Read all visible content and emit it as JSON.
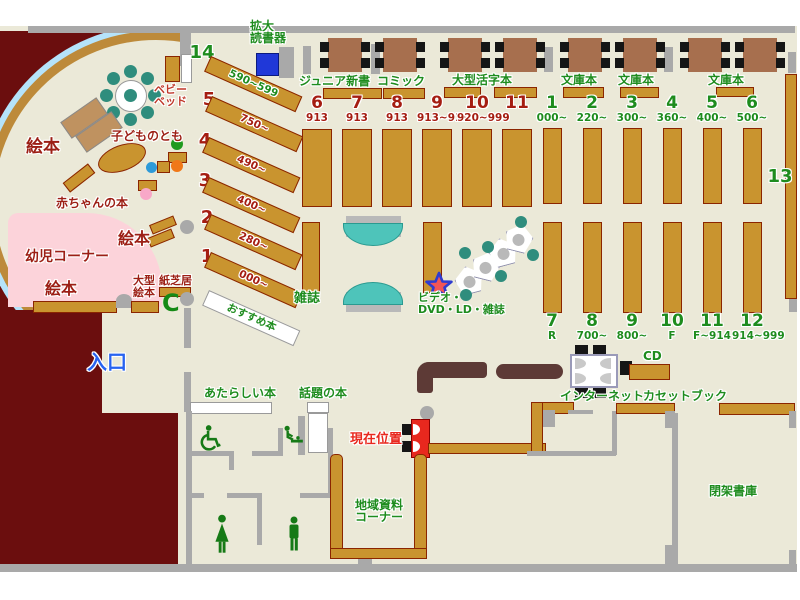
{
  "colors": {
    "floor": "#ebe9d8",
    "maroon": "#6b0e0e",
    "wall_gray": "#a9a9a9",
    "shelf_brown": "#c9942f",
    "shelf_border": "#8b2500",
    "table_brown": "#a76f4e",
    "counter_brown": "#5d3a36",
    "teal": "#2f8d7d",
    "pink": "#fcd3da",
    "arc_blue": "#b5e3fa",
    "green_text": "#1e8c1e",
    "dark_red_text": "#9c1f15",
    "marker_red": "#e8281e",
    "entrance_blue": "#2863f0",
    "reader_blue": "#2038d8"
  },
  "entrance": {
    "label": "入口"
  },
  "current_location": {
    "label": "現在位置"
  },
  "kids_area": {
    "picture_books_1": "絵本",
    "picture_books_2": "絵本",
    "picture_books_3": "絵本",
    "infant_corner": "幼児コーナー",
    "baby_books": "赤ちゃんの本",
    "kodomo_no_tomo": "子どものとも",
    "baby_bed_line1": "ベビー",
    "baby_bed_line2": "ベッド",
    "large_picture_line1": "大型",
    "large_picture_line2": "絵本",
    "kamishibai": "紙芝居",
    "bench_glyph": "C"
  },
  "top_area": {
    "magnifier_line1": "拡大",
    "magnifier_line2": "読書器",
    "junior_shinsho": "ジュニア新書",
    "comic": "コミック",
    "large_print": "大型活字本",
    "bunko_1": "文庫本",
    "bunko_2": "文庫本",
    "bunko_3": "文庫本"
  },
  "rows": {
    "red_top": [
      {
        "n": "6",
        "r": "913"
      },
      {
        "n": "7",
        "r": "913"
      },
      {
        "n": "8",
        "r": "913"
      },
      {
        "n": "9",
        "r": "913~919"
      },
      {
        "n": "10",
        "r": "920~999"
      },
      {
        "n": "11",
        "r": ""
      }
    ],
    "green_top": [
      {
        "n": "1",
        "r": "000~"
      },
      {
        "n": "2",
        "r": "220~"
      },
      {
        "n": "3",
        "r": "300~"
      },
      {
        "n": "4",
        "r": "360~"
      },
      {
        "n": "5",
        "r": "400~"
      },
      {
        "n": "6",
        "r": "500~"
      }
    ],
    "green_bottom": [
      {
        "n": "7",
        "r": "R"
      },
      {
        "n": "8",
        "r": "700~"
      },
      {
        "n": "9",
        "r": "800~"
      },
      {
        "n": "10",
        "r": "F"
      },
      {
        "n": "11",
        "r": "F~914"
      },
      {
        "n": "12",
        "r": "914~999"
      }
    ],
    "diagonal": [
      {
        "n": "14",
        "r": "590~599"
      },
      {
        "n": "5",
        "r": "750~"
      },
      {
        "n": "4",
        "r": "490~"
      },
      {
        "n": "3",
        "r": "400~"
      },
      {
        "n": "2",
        "r": "280~"
      },
      {
        "n": "1",
        "r": "000~"
      }
    ],
    "shelf_13": "13",
    "magazines": "雑誌",
    "video_line1": "ビデオ・",
    "video_line2": "DVD・LD・雑誌",
    "recommended": "おすすめ本"
  },
  "center": {
    "new_books": "あたらしい本",
    "topical_books": "話題の本"
  },
  "services": {
    "internet": "インターネット",
    "cd": "CD",
    "cassette_book": "カセットブック",
    "local_materials_line1": "地域資料",
    "local_materials_line2": "コーナー",
    "closed_stacks": "閉架書庫"
  }
}
